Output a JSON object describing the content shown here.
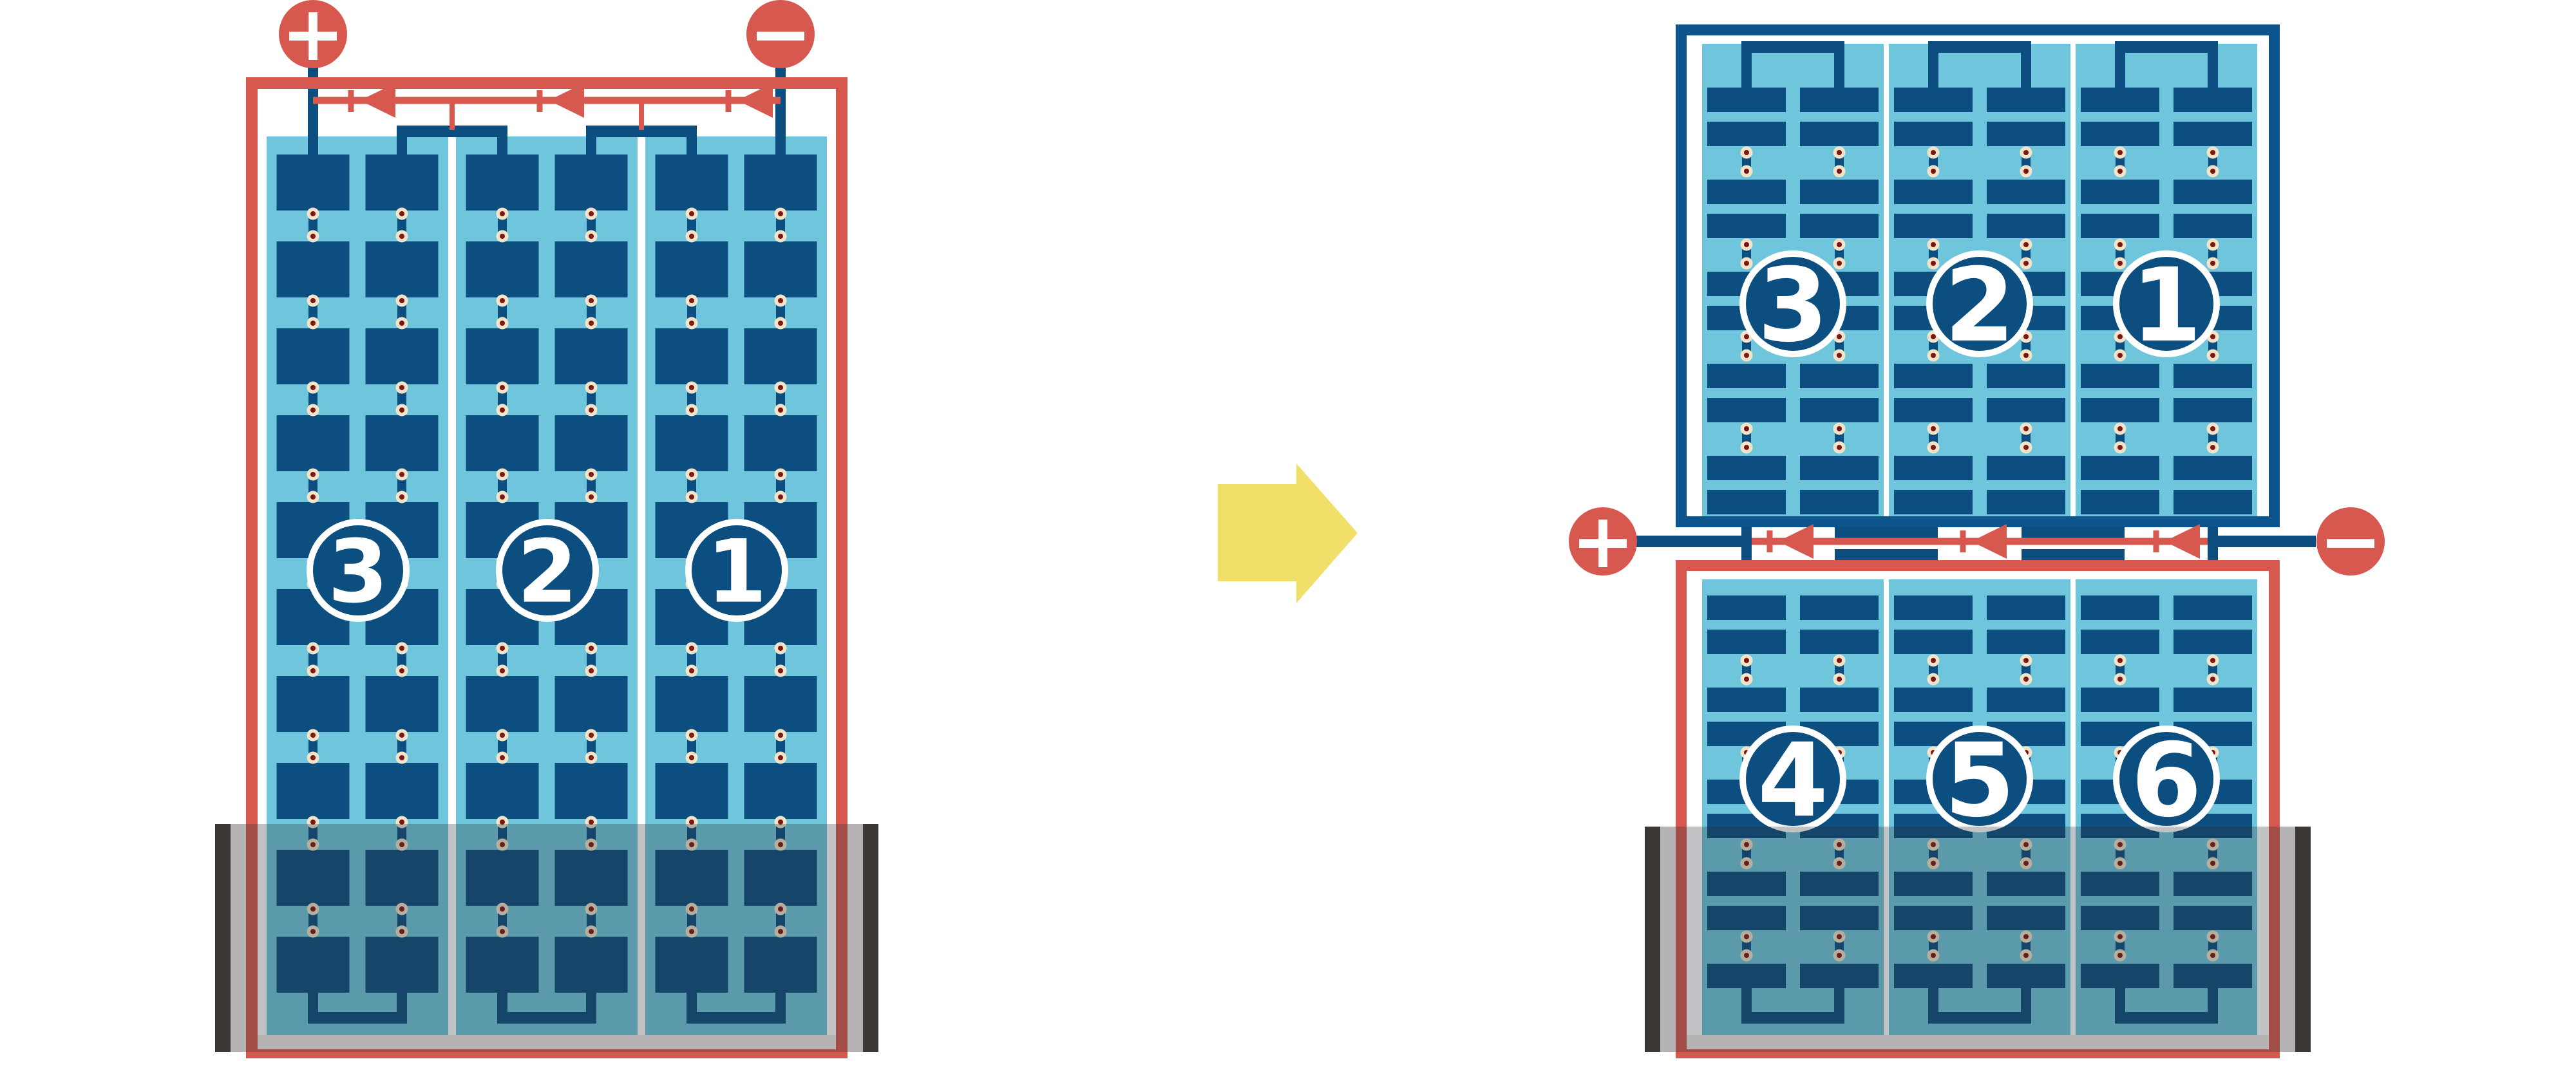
{
  "figure": {
    "description": "Battery pack module reconfiguration diagram: one tall series pack of modules 3-2-1 transformed into two stacked packs (top modules 3-2-1, bottom modules 4-5-6) joined by a central busbar with plus and minus terminals",
    "transform_arrow_direction": "right"
  },
  "colors": {
    "red": "#D6584F",
    "dark_blue": "#0B4E7F",
    "border_blue": "#0E548C",
    "light_blue": "#6FC6DC",
    "cream": "#F2E4C9",
    "dot_red": "#7E1512",
    "yellow": "#F2DF6A",
    "tray_black": "#3B3735",
    "tray_gray": "#B5B3B4",
    "overlay": "rgba(45,52,58,0.30)",
    "white": "#FFFFFF"
  },
  "left_battery": {
    "terminal_positive_label": "+",
    "terminal_negative_label": "−",
    "busbar_arrow_count": 3,
    "busbar_arrow_direction": "left",
    "modules": [
      {
        "label": "3"
      },
      {
        "label": "2"
      },
      {
        "label": "1"
      }
    ]
  },
  "right_battery": {
    "terminal_positive_label": "+",
    "terminal_negative_label": "−",
    "busbar_arrow_count": 3,
    "busbar_arrow_direction": "left",
    "top_modules": [
      {
        "label": "3"
      },
      {
        "label": "2"
      },
      {
        "label": "1"
      }
    ],
    "bottom_modules": [
      {
        "label": "4"
      },
      {
        "label": "5"
      },
      {
        "label": "6"
      }
    ]
  }
}
